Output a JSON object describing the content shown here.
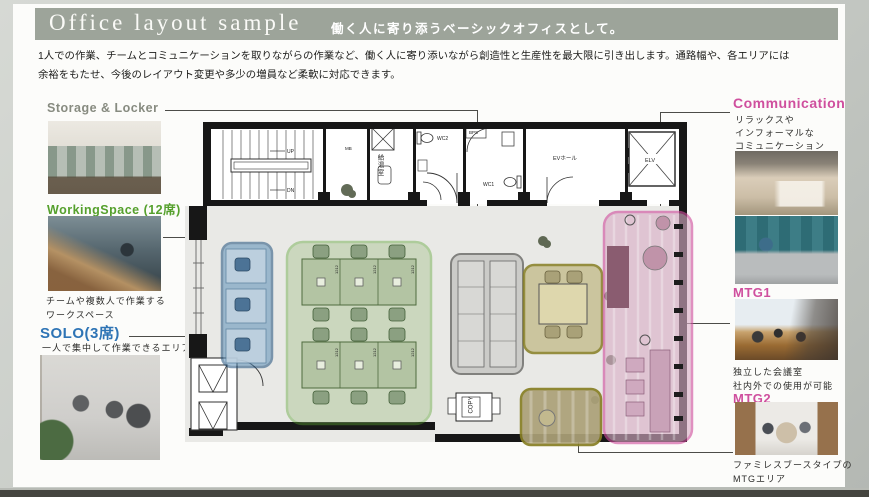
{
  "header": {
    "title": "Office layout sample",
    "subtitle": "働く人に寄り添うベーシックオフィスとして。"
  },
  "intro": "1人での作業、チームとコミュニケーションを取りながらの作業など、働く人に寄り添いながら創造性と生産性を最大限に引き出します。通路幅や、各エリアには\n余裕をもたせ、今後のレイアウト変更や多少の増員など柔軟に対応できます。",
  "areas": {
    "storage": {
      "label": "Storage & Locker"
    },
    "workingspace": {
      "label": "WorkingSpace (12席)",
      "caption": "チームや複数人で作業する\nワークスペース"
    },
    "solo": {
      "label": "SOLO(3席)",
      "caption": "一人で集中して作業できるエリア"
    },
    "communication": {
      "label": "Communication",
      "caption": "リラックスや\nインフォーマルな\nコミュニケーション"
    },
    "mtg1": {
      "label": "MTG1",
      "caption": "独立した会議室\n社内外での使用が可能"
    },
    "mtg2": {
      "label": "MTG2",
      "caption": "ファミレスブースタイプの\nMTGエリア"
    }
  },
  "plan": {
    "stair_up": "UP",
    "stair_dn": "DN",
    "mb": "MB",
    "kitchen": "給湯室",
    "wc2": "WC2",
    "bps": "BPS",
    "wc1": "WC1",
    "ev_hall": "EVホール",
    "elevator": "ELV",
    "copy": "COPY",
    "desk_size": "1212"
  },
  "colors": {
    "header_bar": "#9da49a",
    "accent_green": "#55a02c",
    "accent_blue": "#2e74b5",
    "accent_pink": "#cf4f9e",
    "accent_gray": "#878b80"
  }
}
